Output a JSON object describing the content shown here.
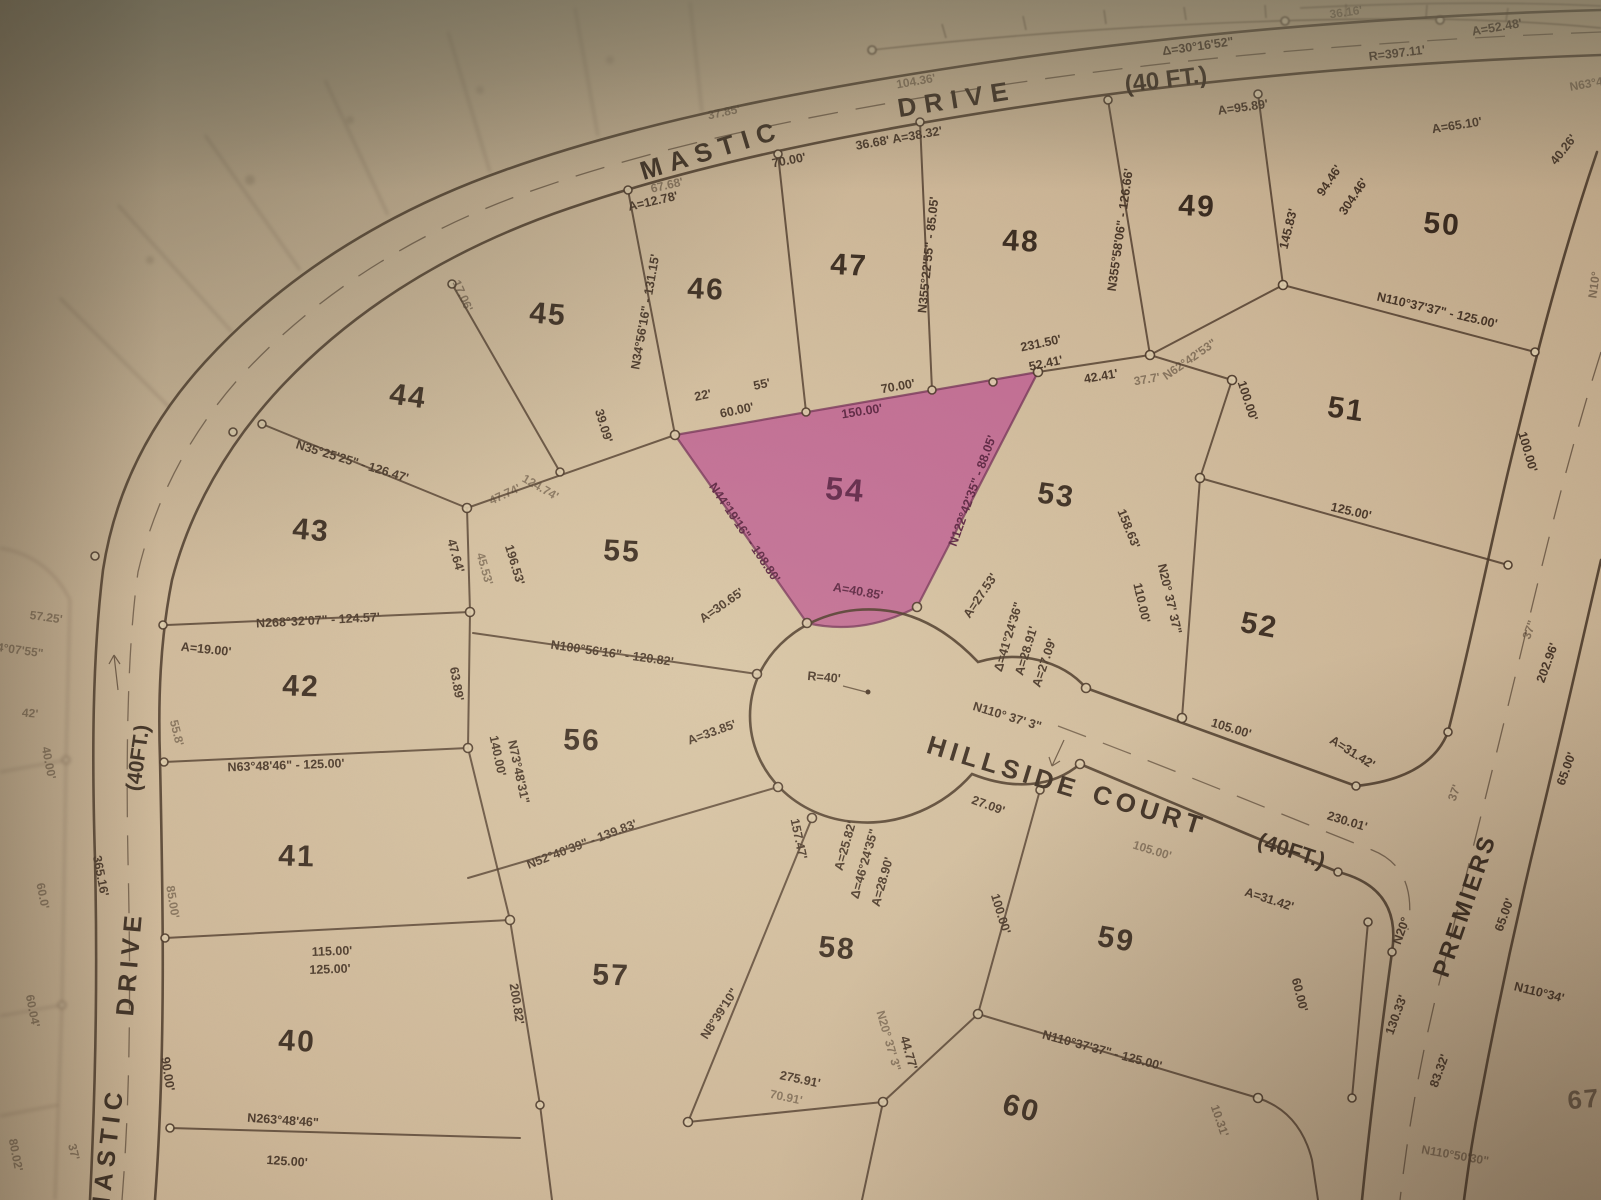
{
  "map": {
    "type": "plat-map-photo",
    "streets": [
      {
        "name": "MASTIC DRIVE",
        "width_label": "(40 FT.)"
      },
      {
        "name": "HILLSIDE COURT",
        "width_label": "(40FT.)"
      },
      {
        "name": "PREMIERS",
        "width_label": ""
      }
    ],
    "highlighted_lot": {
      "number": "54",
      "color": "#bc5890"
    },
    "lot_numbers": [
      "40",
      "41",
      "42",
      "43",
      "44",
      "45",
      "46",
      "47",
      "48",
      "49",
      "50",
      "51",
      "52",
      "53",
      "54",
      "55",
      "56",
      "57",
      "58",
      "59",
      "60",
      "67"
    ],
    "labels": [
      {
        "t": "MASTIC",
        "x": 712,
        "y": 152,
        "r": -17,
        "s": 26,
        "ls": 8,
        "c": "st",
        "n": "street-label-mastic-drive-top-1"
      },
      {
        "t": "DRIVE",
        "x": 957,
        "y": 101,
        "r": -9,
        "s": 26,
        "ls": 8,
        "c": "st",
        "n": "street-label-mastic-drive-top-2"
      },
      {
        "t": "(40 FT.)",
        "x": 1166,
        "y": 81,
        "r": -7,
        "s": 24,
        "c": "st",
        "n": "street-label-mastic-drive-top-width"
      },
      {
        "t": "(40FT.)",
        "x": 139,
        "y": 758,
        "r": -82,
        "s": 21,
        "c": "st",
        "n": "street-label-mastic-drive-left-width"
      },
      {
        "t": "DRIVE",
        "x": 131,
        "y": 963,
        "r": -85,
        "s": 25,
        "ls": 6,
        "c": "st",
        "n": "street-label-mastic-drive-left-2"
      },
      {
        "t": "MASTIC",
        "x": 109,
        "y": 1152,
        "r": -83,
        "s": 25,
        "ls": 6,
        "c": "st",
        "n": "street-label-mastic-drive-left-1"
      },
      {
        "t": "HILLSIDE",
        "x": 1003,
        "y": 769,
        "r": 17,
        "s": 26,
        "ls": 5,
        "c": "st",
        "n": "street-label-hillside-court-1"
      },
      {
        "t": "COURT",
        "x": 1149,
        "y": 812,
        "r": 17,
        "s": 26,
        "ls": 5,
        "c": "st",
        "n": "street-label-hillside-court-2"
      },
      {
        "t": "(40FT.)",
        "x": 1291,
        "y": 852,
        "r": 18,
        "s": 22,
        "c": "st",
        "n": "street-label-hillside-court-width"
      },
      {
        "t": "PREMIERS",
        "x": 1466,
        "y": 906,
        "r": -71,
        "s": 24,
        "ls": 3,
        "c": "st",
        "n": "street-label-premiers"
      },
      {
        "t": "40",
        "x": 297,
        "y": 1043,
        "r": 3,
        "c": "lot"
      },
      {
        "t": "41",
        "x": 297,
        "y": 858,
        "r": 2,
        "c": "lot"
      },
      {
        "t": "42",
        "x": 301,
        "y": 688,
        "r": 2,
        "c": "lot"
      },
      {
        "t": "43",
        "x": 311,
        "y": 532,
        "r": 5,
        "c": "lot"
      },
      {
        "t": "44",
        "x": 408,
        "y": 398,
        "r": 8,
        "c": "lot"
      },
      {
        "t": "45",
        "x": 548,
        "y": 316,
        "r": 5,
        "c": "lot"
      },
      {
        "t": "46",
        "x": 706,
        "y": 291,
        "r": 3,
        "c": "lot"
      },
      {
        "t": "47",
        "x": 849,
        "y": 267,
        "r": 3,
        "c": "lot"
      },
      {
        "t": "48",
        "x": 1021,
        "y": 243,
        "r": 3,
        "c": "lot"
      },
      {
        "t": "49",
        "x": 1197,
        "y": 208,
        "r": 3,
        "c": "lot"
      },
      {
        "t": "50",
        "x": 1442,
        "y": 226,
        "r": 5,
        "c": "lot"
      },
      {
        "t": "51",
        "x": 1346,
        "y": 411,
        "r": 8,
        "c": "lot"
      },
      {
        "t": "52",
        "x": 1259,
        "y": 627,
        "r": 10,
        "c": "lot"
      },
      {
        "t": "53",
        "x": 1056,
        "y": 497,
        "r": 8,
        "c": "lot"
      },
      {
        "t": "54",
        "x": 845,
        "y": 492,
        "r": 5,
        "c": "lotp",
        "n": "lot-number-54-highlighted"
      },
      {
        "t": "55",
        "x": 622,
        "y": 553,
        "r": 3,
        "c": "lot"
      },
      {
        "t": "56",
        "x": 582,
        "y": 742,
        "r": 2,
        "c": "lot"
      },
      {
        "t": "57",
        "x": 611,
        "y": 977,
        "r": 2,
        "c": "lot"
      },
      {
        "t": "58",
        "x": 837,
        "y": 950,
        "r": 5,
        "c": "lot"
      },
      {
        "t": "59",
        "x": 1116,
        "y": 941,
        "r": 10,
        "c": "lot"
      },
      {
        "t": "60",
        "x": 1021,
        "y": 1110,
        "r": 15,
        "c": "lot"
      },
      {
        "t": "67",
        "x": 1584,
        "y": 1101,
        "r": -5,
        "c": "lotf"
      },
      {
        "t": "36.16'",
        "x": 1346,
        "y": 13,
        "r": -8,
        "c": "f"
      },
      {
        "t": "A=52.48'",
        "x": 1497,
        "y": 28,
        "r": -10,
        "c": "d"
      },
      {
        "t": "R=397.11'",
        "x": 1397,
        "y": 54,
        "r": -7,
        "c": "d"
      },
      {
        "t": "Δ=30°16'52\"",
        "x": 1198,
        "y": 47,
        "r": -8,
        "c": "d"
      },
      {
        "t": "104.36'",
        "x": 916,
        "y": 82,
        "r": -10,
        "c": "f"
      },
      {
        "t": "37.85'",
        "x": 724,
        "y": 113,
        "r": -12,
        "c": "f"
      },
      {
        "t": "67.68'",
        "x": 667,
        "y": 186,
        "r": -13,
        "c": "f"
      },
      {
        "t": "A=12.78'",
        "x": 653,
        "y": 202,
        "r": -13,
        "c": "d"
      },
      {
        "t": "70.00'",
        "x": 789,
        "y": 161,
        "r": -11,
        "c": "d"
      },
      {
        "t": "36.68'  A=38.32'",
        "x": 899,
        "y": 139,
        "r": -10,
        "c": "d"
      },
      {
        "t": "A=95.89'",
        "x": 1243,
        "y": 108,
        "r": -8,
        "c": "d"
      },
      {
        "t": "A=65.10'",
        "x": 1457,
        "y": 126,
        "r": -9,
        "c": "d"
      },
      {
        "t": "40.26'",
        "x": 1564,
        "y": 150,
        "r": -52,
        "c": "d"
      },
      {
        "t": "N63°48'",
        "x": 1591,
        "y": 84,
        "r": -10,
        "c": "f"
      },
      {
        "t": "N34°56'16\" - 131.15'",
        "x": 646,
        "y": 312,
        "r": -80,
        "c": "d"
      },
      {
        "t": "N355°22'55\" - 85.05'",
        "x": 929,
        "y": 255,
        "r": -84,
        "c": "d"
      },
      {
        "t": "N355°58'06\" - 126.66'",
        "x": 1121,
        "y": 230,
        "r": -82,
        "c": "d"
      },
      {
        "t": "145.83'",
        "x": 1289,
        "y": 229,
        "r": -76,
        "c": "d"
      },
      {
        "t": "94.46'",
        "x": 1330,
        "y": 181,
        "r": -56,
        "c": "d"
      },
      {
        "t": "304.46'",
        "x": 1354,
        "y": 197,
        "r": -56,
        "c": "d"
      },
      {
        "t": "N110°37'37\" - 125.00'",
        "x": 1437,
        "y": 311,
        "r": 13,
        "c": "d"
      },
      {
        "t": "100.00'",
        "x": 1527,
        "y": 452,
        "r": 74,
        "c": "d"
      },
      {
        "t": "125.00'",
        "x": 1351,
        "y": 512,
        "r": 13,
        "c": "d"
      },
      {
        "t": "N62°42'53\"",
        "x": 1190,
        "y": 360,
        "r": -35,
        "c": "f"
      },
      {
        "t": "231.50'",
        "x": 1041,
        "y": 344,
        "r": -12,
        "c": "d"
      },
      {
        "t": "52.41'",
        "x": 1046,
        "y": 364,
        "r": -12,
        "c": "d"
      },
      {
        "t": "42.41'",
        "x": 1101,
        "y": 377,
        "r": -10,
        "c": "d"
      },
      {
        "t": "37.7'",
        "x": 1147,
        "y": 380,
        "r": -10,
        "c": "f"
      },
      {
        "t": "100.00'",
        "x": 1247,
        "y": 401,
        "r": 72,
        "c": "d"
      },
      {
        "t": "158.63'",
        "x": 1128,
        "y": 529,
        "r": 68,
        "c": "d"
      },
      {
        "t": "110.00'",
        "x": 1141,
        "y": 603,
        "r": 77,
        "c": "d"
      },
      {
        "t": "N20° 37' 37\"",
        "x": 1169,
        "y": 599,
        "r": 77,
        "c": "d"
      },
      {
        "t": "150.00'",
        "x": 862,
        "y": 412,
        "r": -9,
        "c": "dp"
      },
      {
        "t": "N122°42'35\" - 88.05'",
        "x": 973,
        "y": 491,
        "r": -70,
        "c": "dp"
      },
      {
        "t": "N44°19'16\" - 108.80'",
        "x": 744,
        "y": 533,
        "r": 56,
        "c": "dp"
      },
      {
        "t": "A=40.85'",
        "x": 858,
        "y": 592,
        "r": 10,
        "c": "dp"
      },
      {
        "t": "A=30.65'",
        "x": 722,
        "y": 606,
        "r": -35,
        "c": "d"
      },
      {
        "t": "N100°56'16\" - 120.82'",
        "x": 612,
        "y": 654,
        "r": 8,
        "c": "d"
      },
      {
        "t": "A=33.85'",
        "x": 712,
        "y": 733,
        "r": -20,
        "c": "d"
      },
      {
        "t": "R=40'",
        "x": 824,
        "y": 678,
        "r": 5,
        "c": "d"
      },
      {
        "t": "A=27.53'",
        "x": 981,
        "y": 596,
        "r": -56,
        "c": "d"
      },
      {
        "t": "Δ=41°24'36\"",
        "x": 1009,
        "y": 637,
        "r": -73,
        "s": 11,
        "c": "d"
      },
      {
        "t": "A=28.91'",
        "x": 1027,
        "y": 651,
        "r": -73,
        "s": 11,
        "c": "d"
      },
      {
        "t": "A=27.09'",
        "x": 1045,
        "y": 663,
        "r": -71,
        "s": 11,
        "c": "d"
      },
      {
        "t": "N110° 37' 3\"",
        "x": 1007,
        "y": 717,
        "r": 17,
        "c": "d"
      },
      {
        "t": "27.09'",
        "x": 988,
        "y": 806,
        "r": 20,
        "c": "d"
      },
      {
        "t": "A=25.82'",
        "x": 846,
        "y": 846,
        "r": -74,
        "s": 11,
        "c": "d"
      },
      {
        "t": "Δ=46°24'35\"",
        "x": 865,
        "y": 864,
        "r": -74,
        "s": 11,
        "c": "d"
      },
      {
        "t": "A=28.90'",
        "x": 883,
        "y": 882,
        "r": -74,
        "s": 11,
        "c": "d"
      },
      {
        "t": "157.47'",
        "x": 798,
        "y": 839,
        "r": 78,
        "c": "d"
      },
      {
        "t": "105.00'",
        "x": 1231,
        "y": 729,
        "r": 17,
        "c": "d"
      },
      {
        "t": "A=31.42'",
        "x": 1352,
        "y": 753,
        "r": 32,
        "c": "d"
      },
      {
        "t": "230.01'",
        "x": 1347,
        "y": 822,
        "r": 17,
        "c": "d"
      },
      {
        "t": "105.00'",
        "x": 1152,
        "y": 851,
        "r": 17,
        "c": "f"
      },
      {
        "t": "A=31.42'",
        "x": 1269,
        "y": 900,
        "r": 18,
        "c": "d"
      },
      {
        "t": "N35°25'25\" - 126.47'",
        "x": 352,
        "y": 462,
        "r": 17,
        "c": "d"
      },
      {
        "t": "47.64'",
        "x": 455,
        "y": 556,
        "r": 74,
        "c": "d"
      },
      {
        "t": "45.53'",
        "x": 484,
        "y": 569,
        "r": 74,
        "c": "f"
      },
      {
        "t": "196.53'",
        "x": 514,
        "y": 565,
        "r": 73,
        "c": "d"
      },
      {
        "t": "47.74'",
        "x": 505,
        "y": 495,
        "r": -25,
        "c": "f"
      },
      {
        "t": "N268°32'07\" - 124.57'",
        "x": 318,
        "y": 621,
        "r": -3,
        "c": "d"
      },
      {
        "t": "A=19.00'",
        "x": 206,
        "y": 650,
        "r": 6,
        "c": "d"
      },
      {
        "t": "63.89'",
        "x": 456,
        "y": 684,
        "r": 80,
        "c": "d"
      },
      {
        "t": "N63°48'46\" - 125.00'",
        "x": 286,
        "y": 766,
        "r": -2,
        "c": "d"
      },
      {
        "t": "55.8'",
        "x": 176,
        "y": 733,
        "r": 76,
        "c": "f"
      },
      {
        "t": "140.00'",
        "x": 497,
        "y": 756,
        "r": 78,
        "c": "d"
      },
      {
        "t": "N73°48'31\"",
        "x": 518,
        "y": 772,
        "r": 78,
        "c": "d"
      },
      {
        "t": "N52°40'39\" - 139.83'",
        "x": 582,
        "y": 845,
        "r": -21,
        "c": "d"
      },
      {
        "t": "200.82'",
        "x": 516,
        "y": 1004,
        "r": 81,
        "c": "d"
      },
      {
        "t": "115.00'",
        "x": 332,
        "y": 952,
        "r": -2,
        "c": "d"
      },
      {
        "t": "125.00'",
        "x": 330,
        "y": 970,
        "r": -2,
        "c": "d"
      },
      {
        "t": "90.00'",
        "x": 167,
        "y": 1074,
        "r": 81,
        "c": "d"
      },
      {
        "t": "85.00'",
        "x": 172,
        "y": 902,
        "r": 81,
        "c": "f"
      },
      {
        "t": "N263°48'46\"",
        "x": 283,
        "y": 1121,
        "r": 4,
        "c": "d"
      },
      {
        "t": "125.00'",
        "x": 287,
        "y": 1162,
        "r": 4,
        "c": "d"
      },
      {
        "t": "365.16'",
        "x": 100,
        "y": 876,
        "r": 79,
        "c": "d"
      },
      {
        "t": "37'",
        "x": 73,
        "y": 1152,
        "r": 76,
        "c": "f"
      },
      {
        "t": "60.0'",
        "x": 42,
        "y": 896,
        "r": 79,
        "c": "f"
      },
      {
        "t": "60.04'",
        "x": 32,
        "y": 1011,
        "r": 79,
        "c": "f"
      },
      {
        "t": "80.02'",
        "x": 15,
        "y": 1155,
        "r": 79,
        "c": "f"
      },
      {
        "t": "40.00'",
        "x": 48,
        "y": 763,
        "r": 79,
        "c": "f"
      },
      {
        "t": "57.25'",
        "x": 46,
        "y": 618,
        "r": 8,
        "c": "f"
      },
      {
        "t": "4°07'55\"",
        "x": 20,
        "y": 651,
        "r": 8,
        "c": "f"
      },
      {
        "t": "42'",
        "x": 30,
        "y": 714,
        "r": 5,
        "c": "f"
      },
      {
        "t": "39.09'",
        "x": 603,
        "y": 426,
        "r": 73,
        "c": "d"
      },
      {
        "t": "22'",
        "x": 703,
        "y": 396,
        "r": -12,
        "c": "d"
      },
      {
        "t": "55'",
        "x": 762,
        "y": 385,
        "r": -12,
        "c": "d"
      },
      {
        "t": "60.00'",
        "x": 737,
        "y": 411,
        "r": -12,
        "c": "d"
      },
      {
        "t": "70.00'",
        "x": 898,
        "y": 387,
        "r": -10,
        "c": "d"
      },
      {
        "t": "17.06'",
        "x": 462,
        "y": 296,
        "r": 66,
        "c": "f"
      },
      {
        "t": "124.74'",
        "x": 540,
        "y": 488,
        "r": 30,
        "c": "f"
      },
      {
        "t": "100.00'",
        "x": 1000,
        "y": 914,
        "r": 73,
        "c": "d"
      },
      {
        "t": "60.00'",
        "x": 1299,
        "y": 995,
        "r": 76,
        "c": "d"
      },
      {
        "t": "N110°37'37\" - 125.00'",
        "x": 1102,
        "y": 1051,
        "r": 15,
        "c": "d"
      },
      {
        "t": "N20° 37' 3\"",
        "x": 888,
        "y": 1041,
        "r": 74,
        "s": 11,
        "c": "f"
      },
      {
        "t": "44.77'",
        "x": 908,
        "y": 1053,
        "r": 74,
        "c": "d"
      },
      {
        "t": "275.91'",
        "x": 800,
        "y": 1080,
        "r": 12,
        "c": "d"
      },
      {
        "t": "70.91'",
        "x": 786,
        "y": 1098,
        "r": 12,
        "c": "f"
      },
      {
        "t": "N8°39'10\"",
        "x": 720,
        "y": 1014,
        "r": -57,
        "c": "d"
      },
      {
        "t": "10.31'",
        "x": 1219,
        "y": 1121,
        "r": 71,
        "c": "f"
      },
      {
        "t": "N20°",
        "x": 1402,
        "y": 931,
        "r": -70,
        "c": "d"
      },
      {
        "t": "130.33'",
        "x": 1397,
        "y": 1015,
        "r": -70,
        "c": "d"
      },
      {
        "t": "83.32'",
        "x": 1440,
        "y": 1071,
        "r": -70,
        "c": "d"
      },
      {
        "t": "65.00'",
        "x": 1505,
        "y": 915,
        "r": -70,
        "c": "d"
      },
      {
        "t": "N110°34'",
        "x": 1539,
        "y": 993,
        "r": 14,
        "c": "d"
      },
      {
        "t": "N110°50'30\"",
        "x": 1455,
        "y": 1156,
        "r": 10,
        "c": "f"
      },
      {
        "t": "N10°",
        "x": 1595,
        "y": 285,
        "r": -82,
        "c": "f"
      },
      {
        "t": "202.96'",
        "x": 1548,
        "y": 663,
        "r": -70,
        "c": "d"
      },
      {
        "t": "37\"",
        "x": 1530,
        "y": 630,
        "r": -70,
        "c": "f"
      },
      {
        "t": "65.00'",
        "x": 1567,
        "y": 769,
        "r": -70,
        "c": "d"
      },
      {
        "t": "37'",
        "x": 1455,
        "y": 793,
        "r": -70,
        "c": "f"
      }
    ]
  },
  "palette": {
    "paper": "#c9b294",
    "line": "#483526",
    "ink": "#3b2b1f",
    "pink": "#bc5890"
  }
}
